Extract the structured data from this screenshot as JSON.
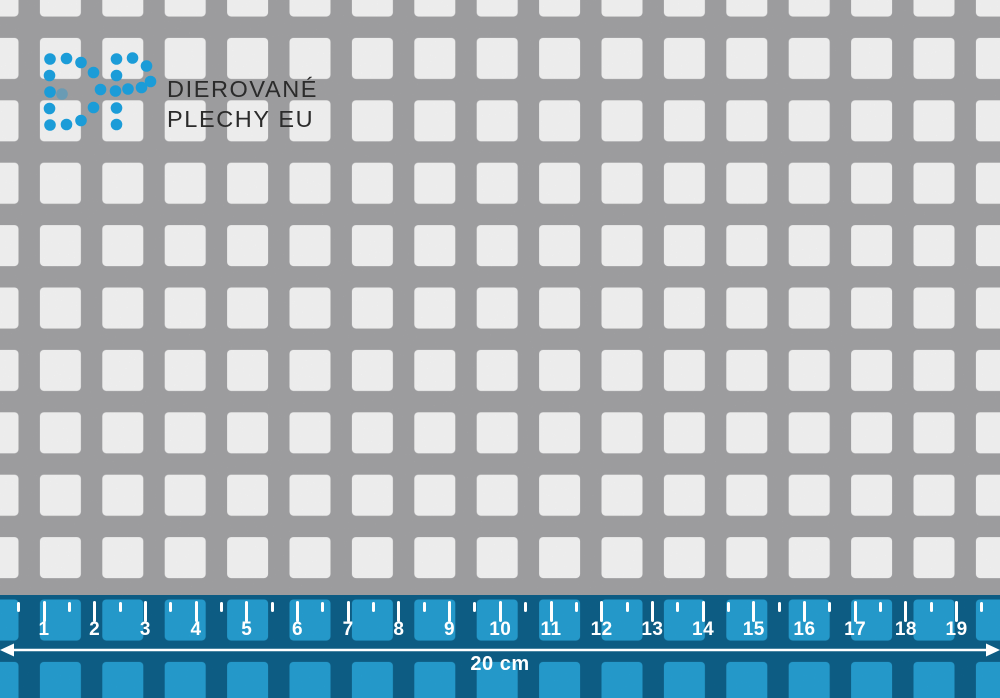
{
  "brand": {
    "logo_alt": "DP",
    "line1": "DIEROVANÉ",
    "line2": "PLECHY EU"
  },
  "ruler": {
    "numbers": [
      "1",
      "2",
      "3",
      "4",
      "5",
      "6",
      "7",
      "8",
      "9",
      "10",
      "11",
      "12",
      "13",
      "14",
      "15",
      "16",
      "17",
      "18",
      "19"
    ],
    "total_label": "20 cm"
  },
  "colors": {
    "sheet_gray": "#a9a9ab",
    "hole_white": "#ffffff",
    "dot_blue": "#1b9cd8",
    "ruler_square_blue": "#27a5da",
    "ruler_gap_blue": "#0f648e",
    "text_dark": "#2b2b2b",
    "ruler_text_white": "#ffffff"
  }
}
